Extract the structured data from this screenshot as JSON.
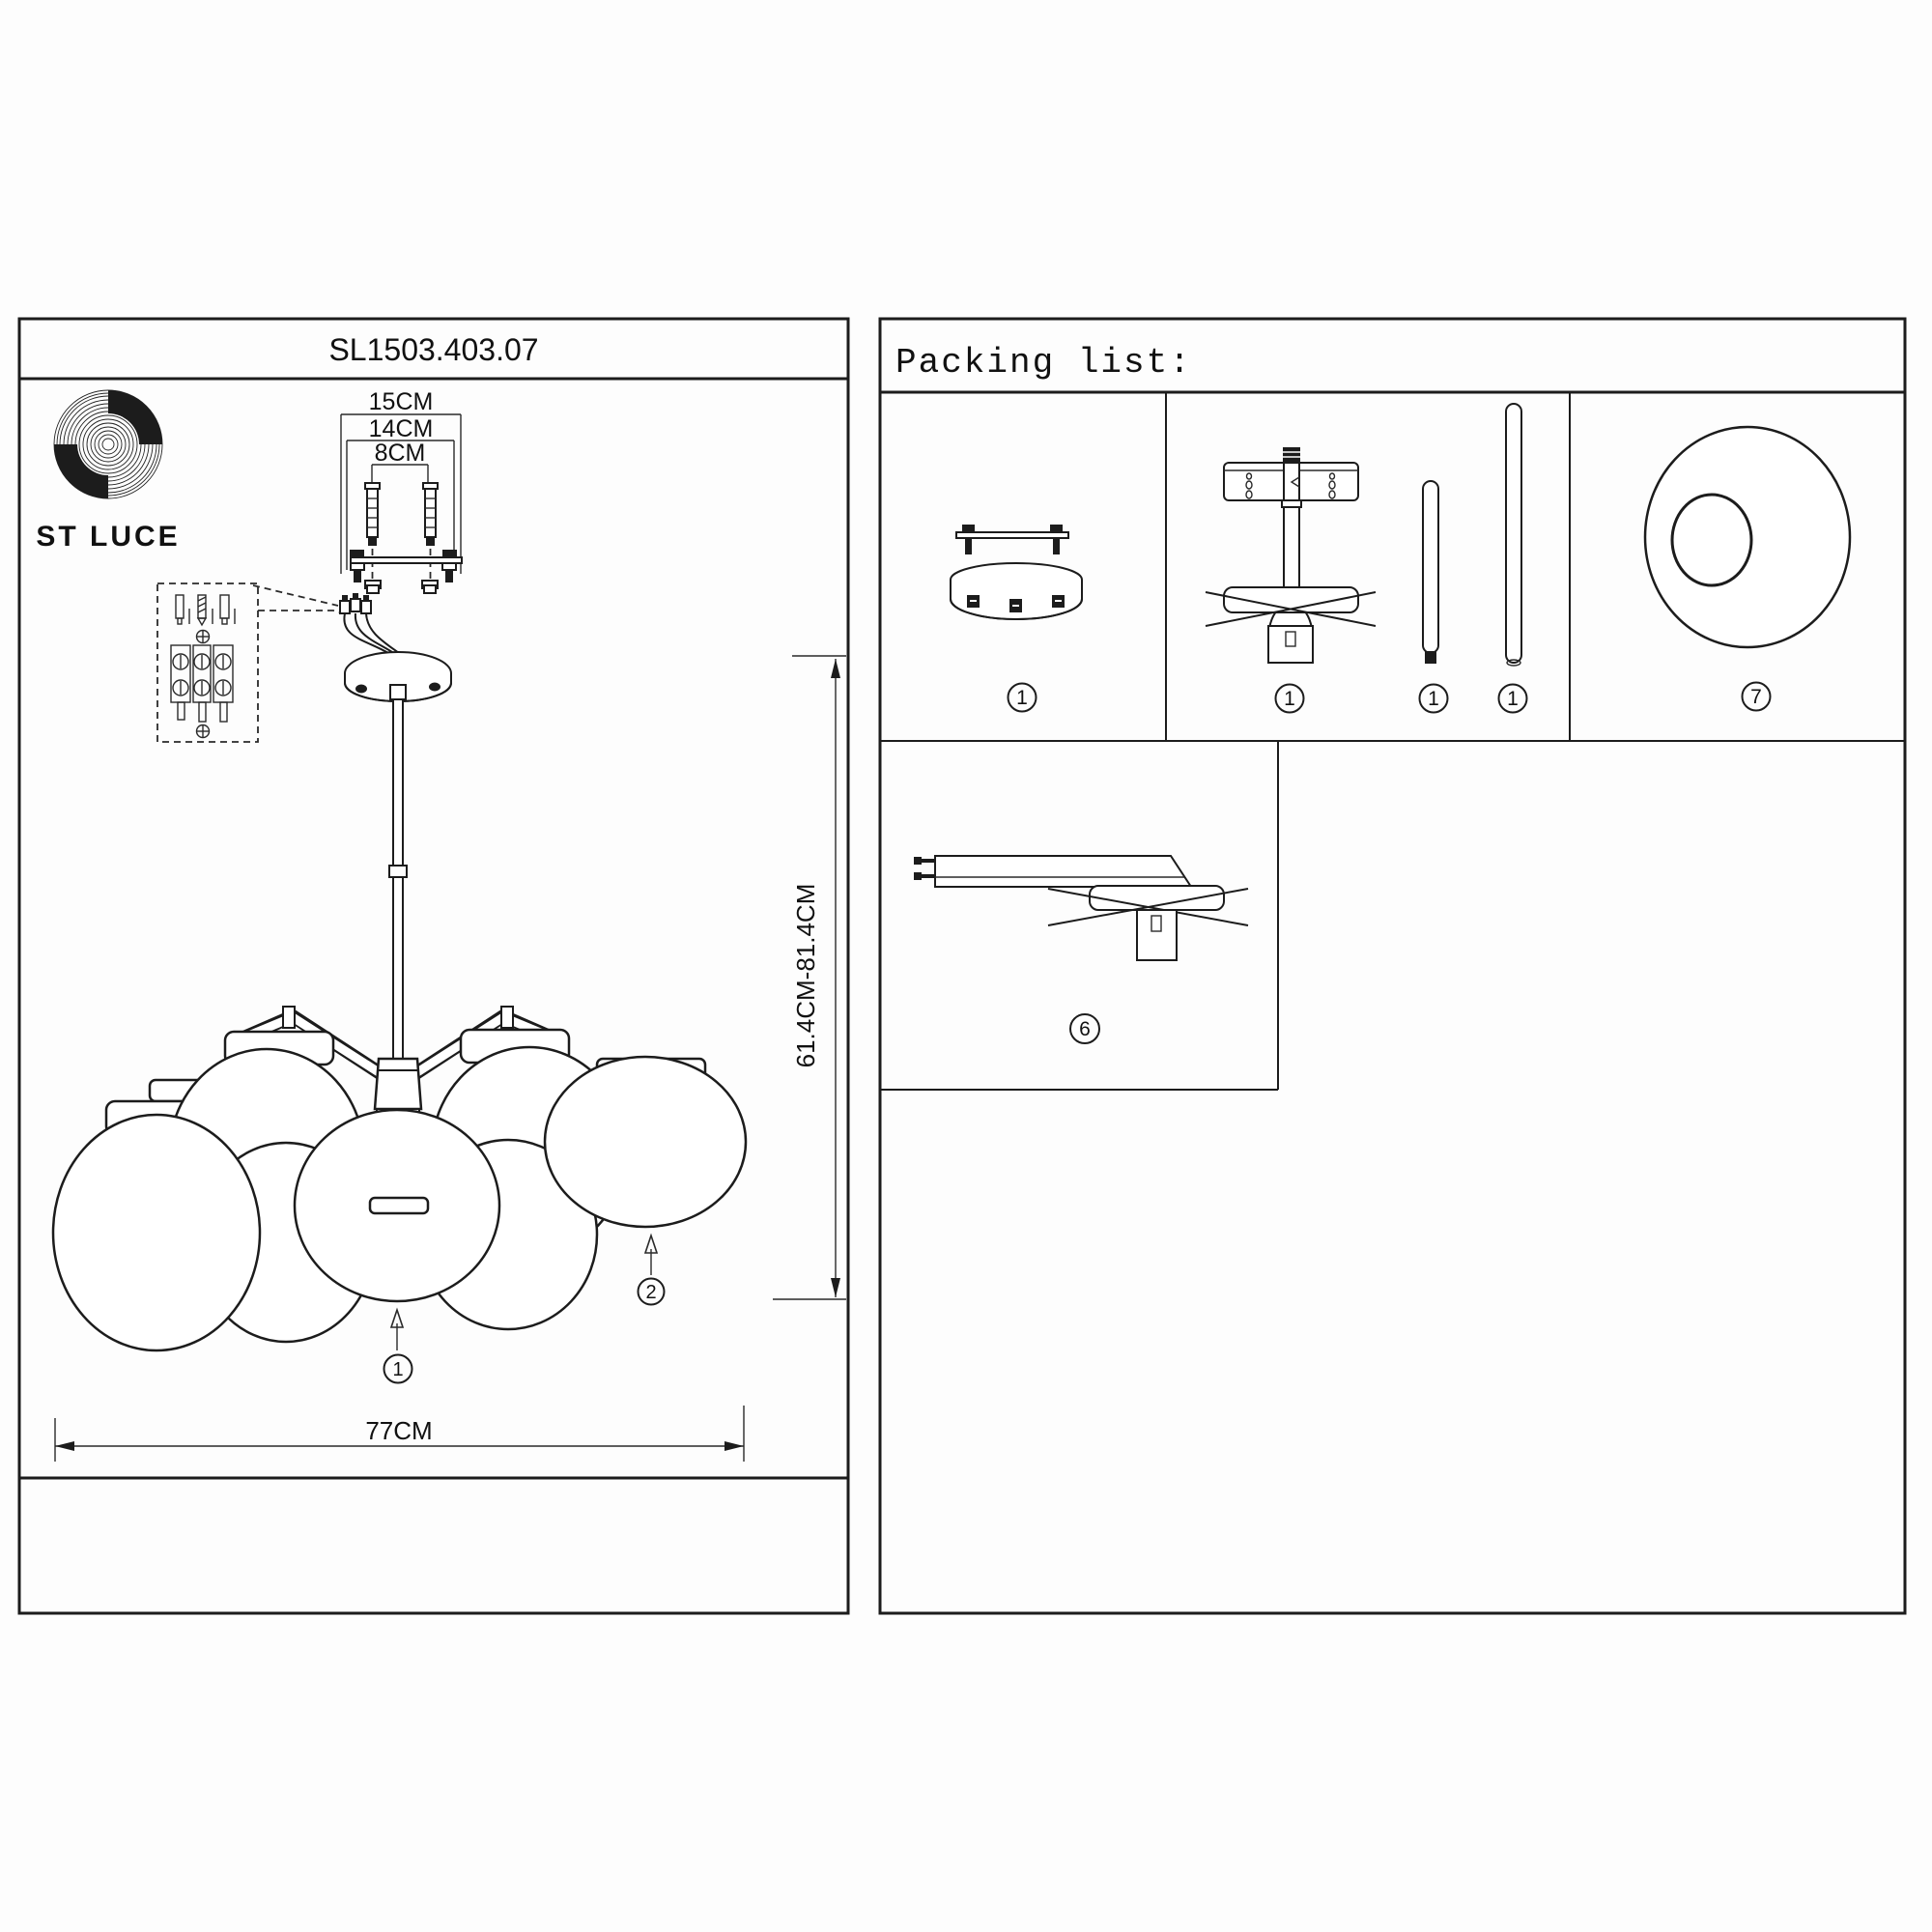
{
  "left_panel": {
    "model_number": "SL1503.403.07",
    "brand": "ST LUCE",
    "dimensions": {
      "bracket_outer": "15CM",
      "bracket_middle": "14CM",
      "bracket_inner": "8CM",
      "hanging_height": "61.4CM-81.4CM",
      "fixture_width": "77CM"
    },
    "callouts": {
      "front_shade": "1",
      "side_shade": "2"
    }
  },
  "packing_list": {
    "title": "Packing list:",
    "items": [
      {
        "name": "ceiling-canopy-with-bracket",
        "qty": "1"
      },
      {
        "name": "central-rod-assembly",
        "qty": "1"
      },
      {
        "name": "short-rod",
        "qty": "1"
      },
      {
        "name": "long-rod",
        "qty": "1"
      },
      {
        "name": "glass-shade",
        "qty": "7"
      },
      {
        "name": "arm-with-socket",
        "qty": "6"
      }
    ]
  },
  "colors": {
    "line": "#1c1c1c",
    "background": "#fdfdfd"
  }
}
